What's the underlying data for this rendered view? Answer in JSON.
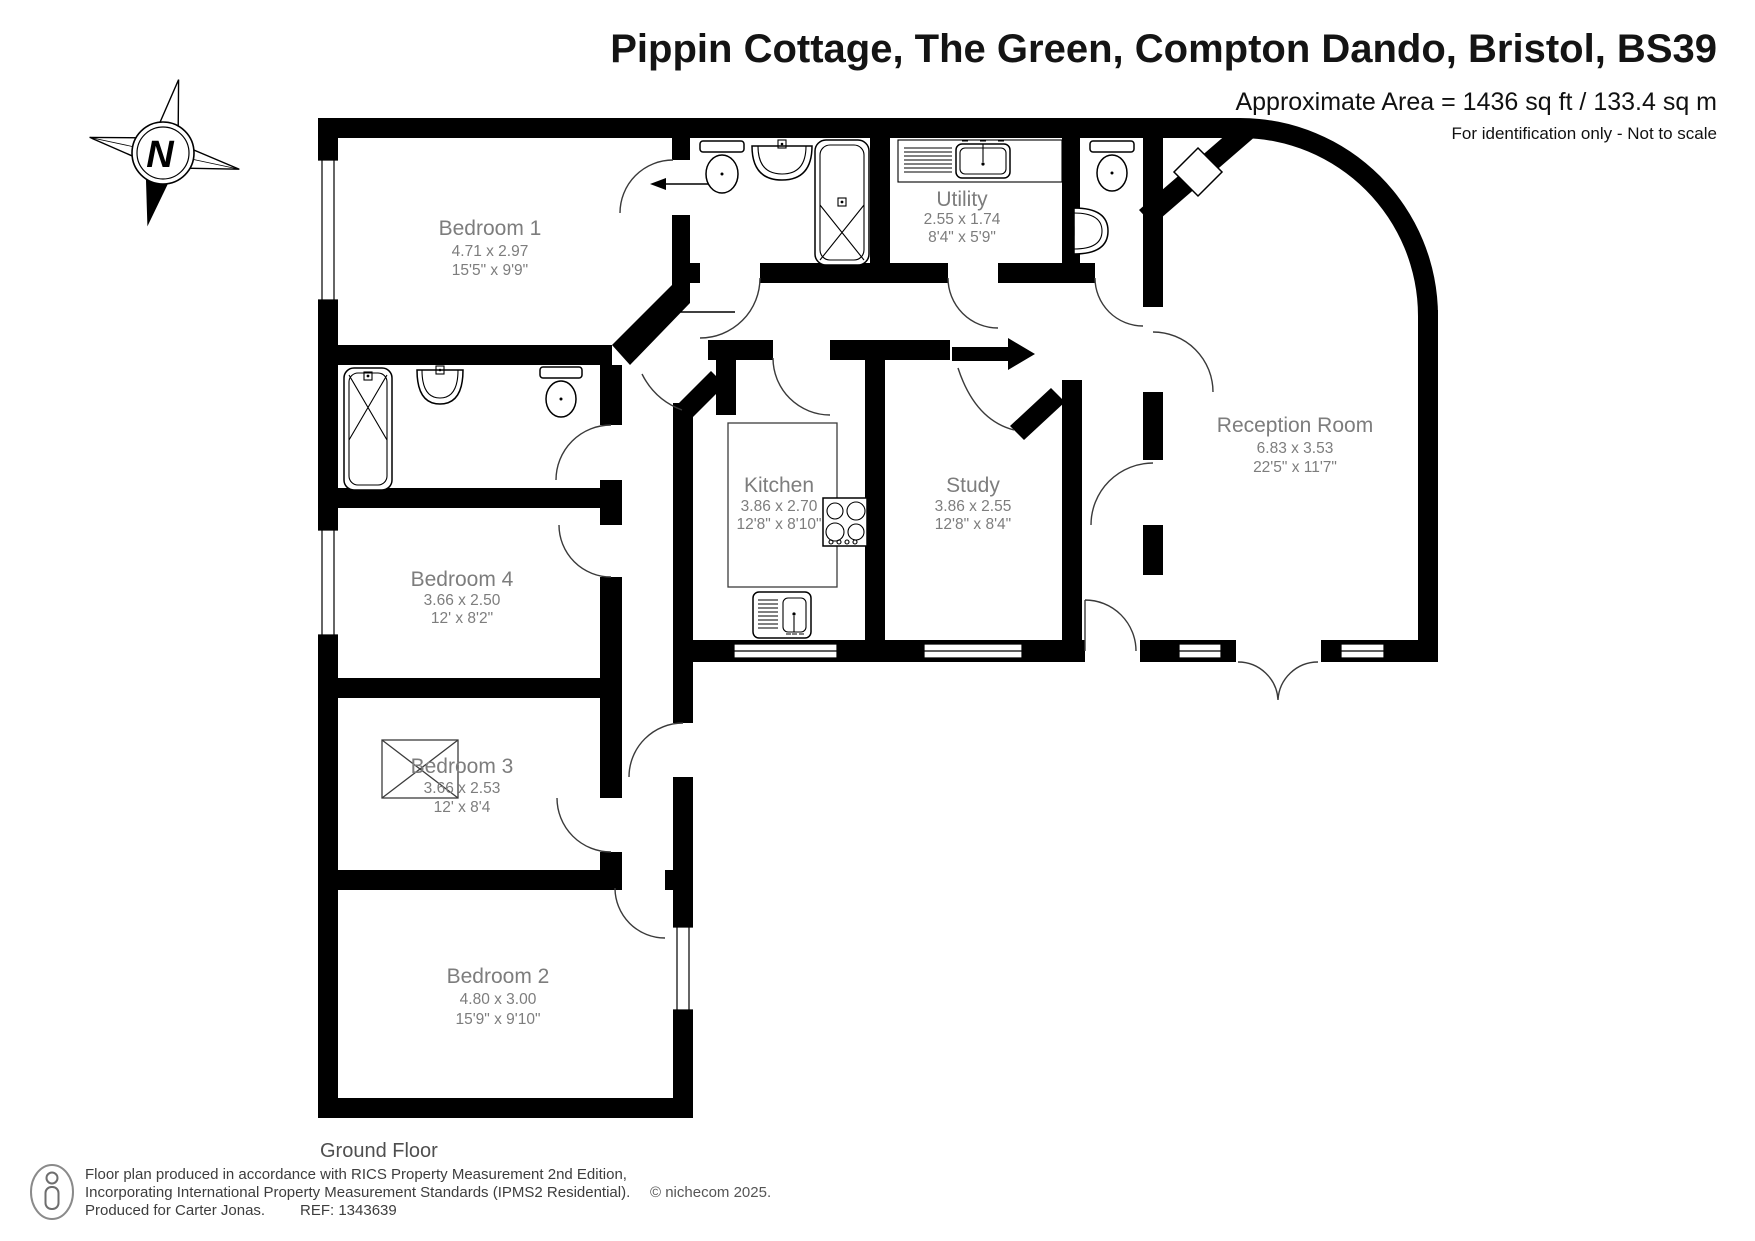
{
  "header": {
    "title": "Pippin Cottage, The Green, Compton Dando, Bristol, BS39",
    "area_line": "Approximate Area = 1436 sq ft / 133.4 sq m",
    "disclaimer": "For identification only - Not to scale"
  },
  "compass": {
    "north_label": "N"
  },
  "plan": {
    "floor_label": "Ground Floor",
    "rooms": [
      {
        "name": "Bedroom 1",
        "metric": "4.71 x 2.97",
        "imperial": "15'5\" x 9'9\""
      },
      {
        "name": "Utility",
        "metric": "2.55 x 1.74",
        "imperial": "8'4\" x 5'9\""
      },
      {
        "name": "Reception Room",
        "metric": "6.83 x 3.53",
        "imperial": "22'5\" x 11'7\""
      },
      {
        "name": "Kitchen",
        "metric": "3.86 x 2.70",
        "imperial": "12'8\" x 8'10\""
      },
      {
        "name": "Study",
        "metric": "3.86 x 2.55",
        "imperial": "12'8\" x 8'4\""
      },
      {
        "name": "Bedroom 4",
        "metric": "3.66 x 2.50",
        "imperial": "12' x 8'2\""
      },
      {
        "name": "Bedroom 3",
        "metric": "3.66 x 2.53",
        "imperial": "12' x 8'4"
      },
      {
        "name": "Bedroom 2",
        "metric": "4.80 x 3.00",
        "imperial": "15'9\" x 9'10\""
      }
    ]
  },
  "footer": {
    "line1": "Floor plan produced in accordance with RICS Property Measurement 2nd Edition,",
    "line2": "Incorporating International Property Measurement Standards (IPMS2 Residential).",
    "copyright": "© nichecom 2025.",
    "produced_for": "Produced for Carter Jonas.",
    "reference": "REF: 1343639"
  },
  "colors": {
    "wall": "#000000",
    "label": "#7d7d7d",
    "title": "#141414"
  }
}
